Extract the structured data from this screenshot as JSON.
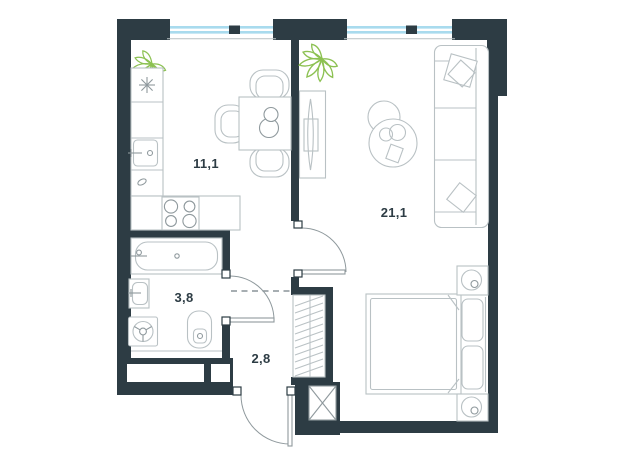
{
  "plan": {
    "type": "apartment-floor-plan",
    "rooms": [
      {
        "name": "kitchen",
        "area_label": "11,1"
      },
      {
        "name": "living-room",
        "area_label": "21,1"
      },
      {
        "name": "bathroom",
        "area_label": "3,8"
      },
      {
        "name": "hallway",
        "area_label": "2,8"
      }
    ]
  },
  "colors": {
    "wall": "#2d3c44",
    "line": "#b9c1c4",
    "line-strong": "#8f999d",
    "glass": "#a9dbee",
    "plant": "#8cc152",
    "label": "#2d3c44",
    "dash": "#8a9398",
    "bg": "#ffffff"
  }
}
